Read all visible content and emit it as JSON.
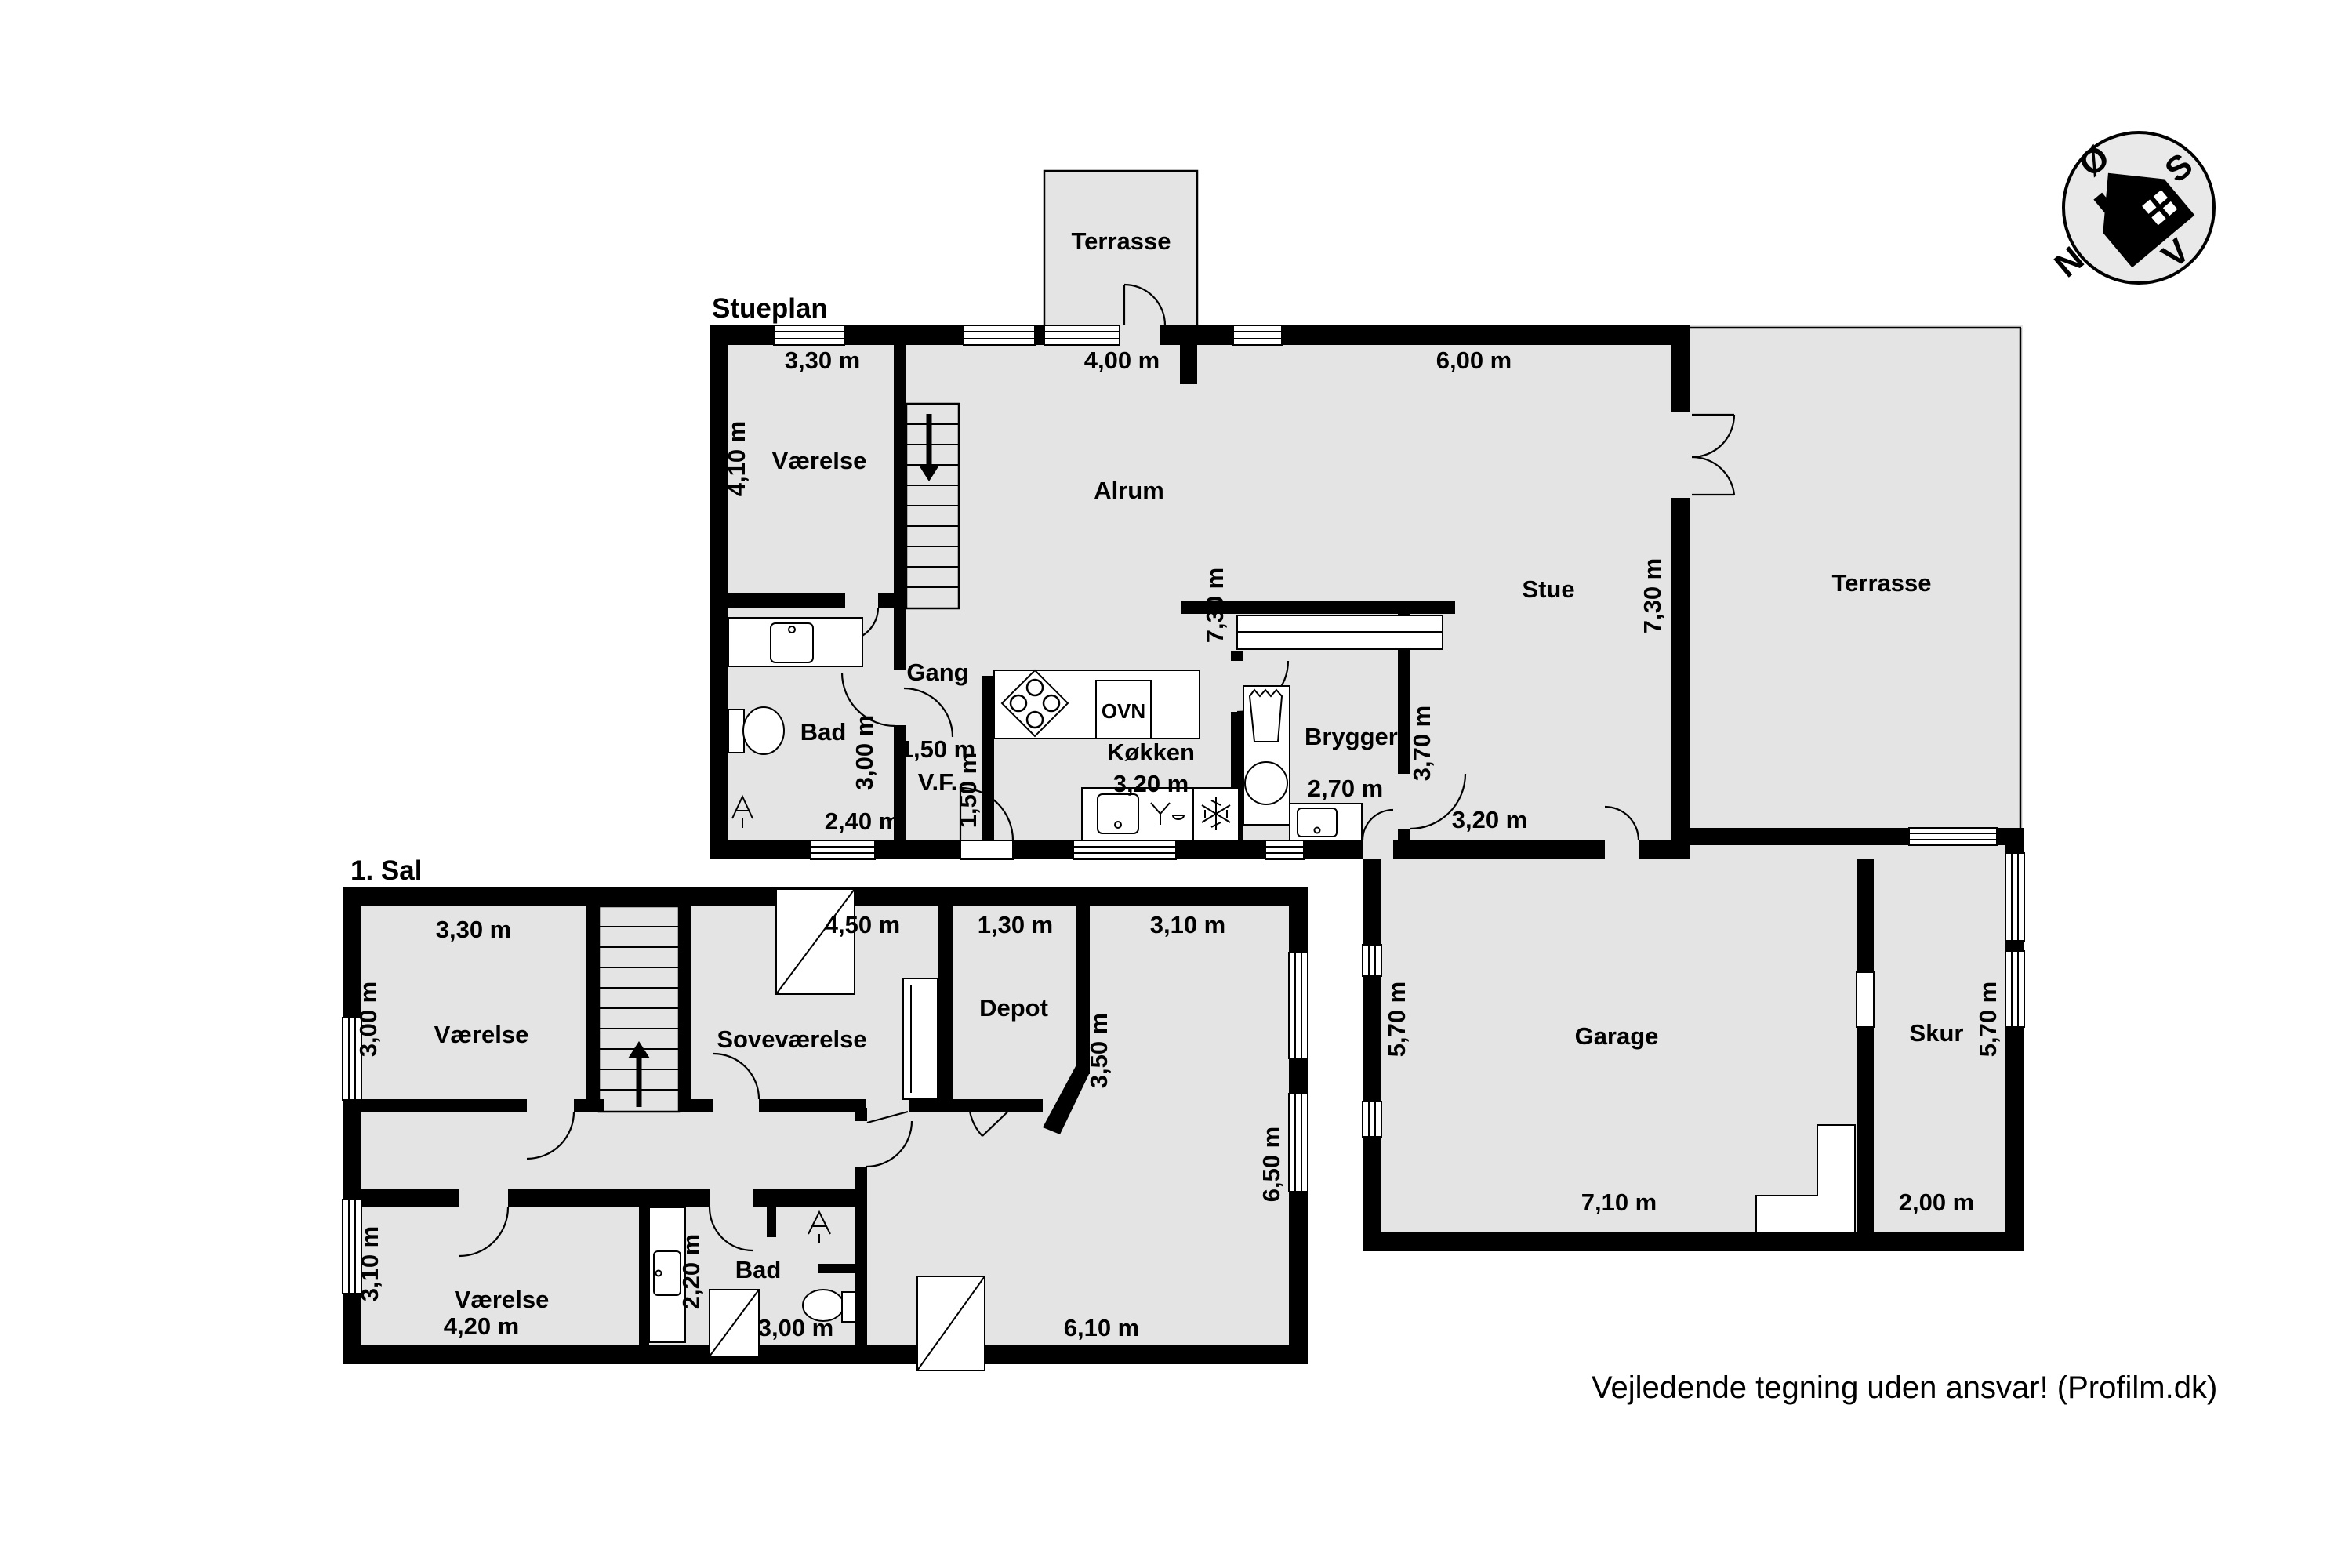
{
  "colors": {
    "room_fill": "#e4e4e4",
    "wall": "#000000",
    "paper": "#ffffff"
  },
  "stueplan": {
    "title": "Stueplan",
    "labels": {
      "terrasse_top": "Terrasse",
      "vaerelse": "Værelse",
      "alrum": "Alrum",
      "stue": "Stue",
      "terrasse": "Terrasse",
      "gang": "Gang",
      "bad": "Bad",
      "vf": "V.F.",
      "koekken": "Køkken",
      "ovn": "OVN",
      "bryggers": "Bryggers",
      "garage": "Garage",
      "skur": "Skur"
    },
    "dims": {
      "vaerelse_w": "3,30 m",
      "alrum_w": "4,00 m",
      "stue_w": "6,00 m",
      "vaerelse_h": "4,10 m",
      "alrum_h": "7,30 m",
      "stue_h": "7,30 m",
      "bad_h": "3,00 m",
      "gang_w": "1,50 m",
      "vf_h": "1,50 m",
      "bad_w": "2,40 m",
      "koekken_w": "3,20 m",
      "bryggers_w": "2,70 m",
      "bryggers_h": "3,70 m",
      "stue_s": "3,20 m",
      "garage_h": "5,70 m",
      "garage_w": "7,10 m",
      "skur_h": "5,70 m",
      "skur_w": "2,00 m"
    }
  },
  "sal": {
    "title": "1. Sal",
    "labels": {
      "vaerelse_nw": "Værelse",
      "sovevaerelse": "Soveværelse",
      "depot": "Depot",
      "vaerelse_sw": "Værelse",
      "bad": "Bad"
    },
    "dims": {
      "vaerelse_nw_w": "3,30 m",
      "vaerelse_nw_h": "3,00 m",
      "sove_w": "4,50 m",
      "depot_w": "1,30 m",
      "depot_h": "3,50 m",
      "east_w": "3,10 m",
      "east_h": "6,50 m",
      "vaerelse_sw_h": "3,10 m",
      "vaerelse_sw_w": "4,20 m",
      "bad_corridor": "2,20 m",
      "bad_w": "3,00 m",
      "south_w": "6,10 m"
    }
  },
  "compass": {
    "north": "N",
    "south": "S",
    "east": "Ø",
    "west": "V"
  },
  "footer": {
    "disclaimer": "Vejledende tegning uden ansvar! (Profilm.dk)"
  }
}
